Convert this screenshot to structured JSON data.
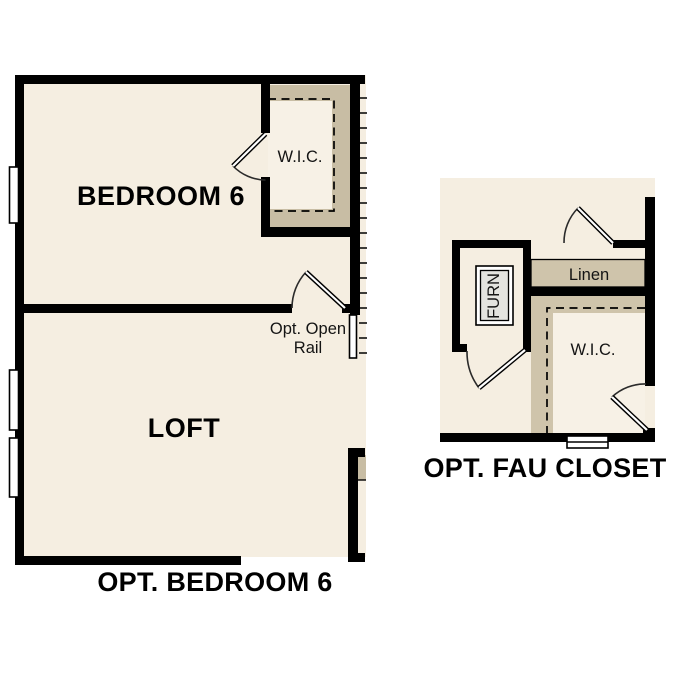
{
  "sheet": {
    "background_color": "#ffffff",
    "wall_color": "#000000",
    "floor_color": "#f5eee1",
    "closet_fill_left_plan": "#c8bda4",
    "closet_fill_right_plan": "#cfc4ab",
    "closet_interior_color": "#f7f1e6",
    "furnace_unit_fill": "#e3e3df"
  },
  "plan_bedroom6": {
    "title": "OPT. BEDROOM 6",
    "bedroom_label": "BEDROOM 6",
    "wic_label": "W.I.C.",
    "loft_label": "LOFT",
    "open_rail_line1": "Opt. Open",
    "open_rail_line2": "Rail"
  },
  "plan_fau_closet": {
    "title": "OPT. FAU CLOSET",
    "furnace_label": "FURN",
    "linen_label": "Linen",
    "wic_label": "W.I.C."
  }
}
